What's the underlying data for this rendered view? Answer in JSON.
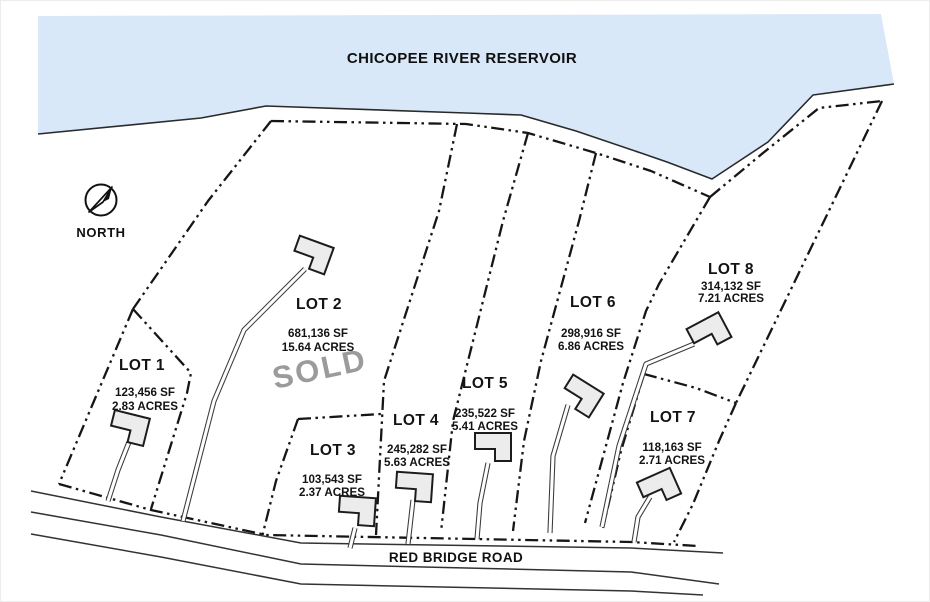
{
  "map": {
    "title": "CHICOPEE RIVER RESERVOIR",
    "road_label": "RED BRIDGE ROAD",
    "compass_label": "NORTH",
    "colors": {
      "water": "#d9e8f9",
      "line": "#161616",
      "sold_text": "#9b9b9b",
      "house_fill": "#ececec"
    },
    "lots": [
      {
        "name": "LOT 1",
        "area_sf": "123,456 SF",
        "area_acres": "2.83 ACRES",
        "status": ""
      },
      {
        "name": "LOT 2",
        "area_sf": "681,136 SF",
        "area_acres": "15.64 ACRES",
        "status": "SOLD"
      },
      {
        "name": "LOT 3",
        "area_sf": "103,543 SF",
        "area_acres": "2.37 ACRES",
        "status": ""
      },
      {
        "name": "LOT 4",
        "area_sf": "245,282 SF",
        "area_acres": "5.63 ACRES",
        "status": ""
      },
      {
        "name": "LOT 5",
        "area_sf": "235,522 SF",
        "area_acres": "5.41 ACRES",
        "status": ""
      },
      {
        "name": "LOT 6",
        "area_sf": "298,916 SF",
        "area_acres": "6.86 ACRES",
        "status": ""
      },
      {
        "name": "LOT 7",
        "area_sf": "118,163 SF",
        "area_acres": "2.71 ACRES",
        "status": ""
      },
      {
        "name": "LOT 8",
        "area_sf": "314,132 SF",
        "area_acres": "7.21 ACRES",
        "status": ""
      }
    ]
  }
}
